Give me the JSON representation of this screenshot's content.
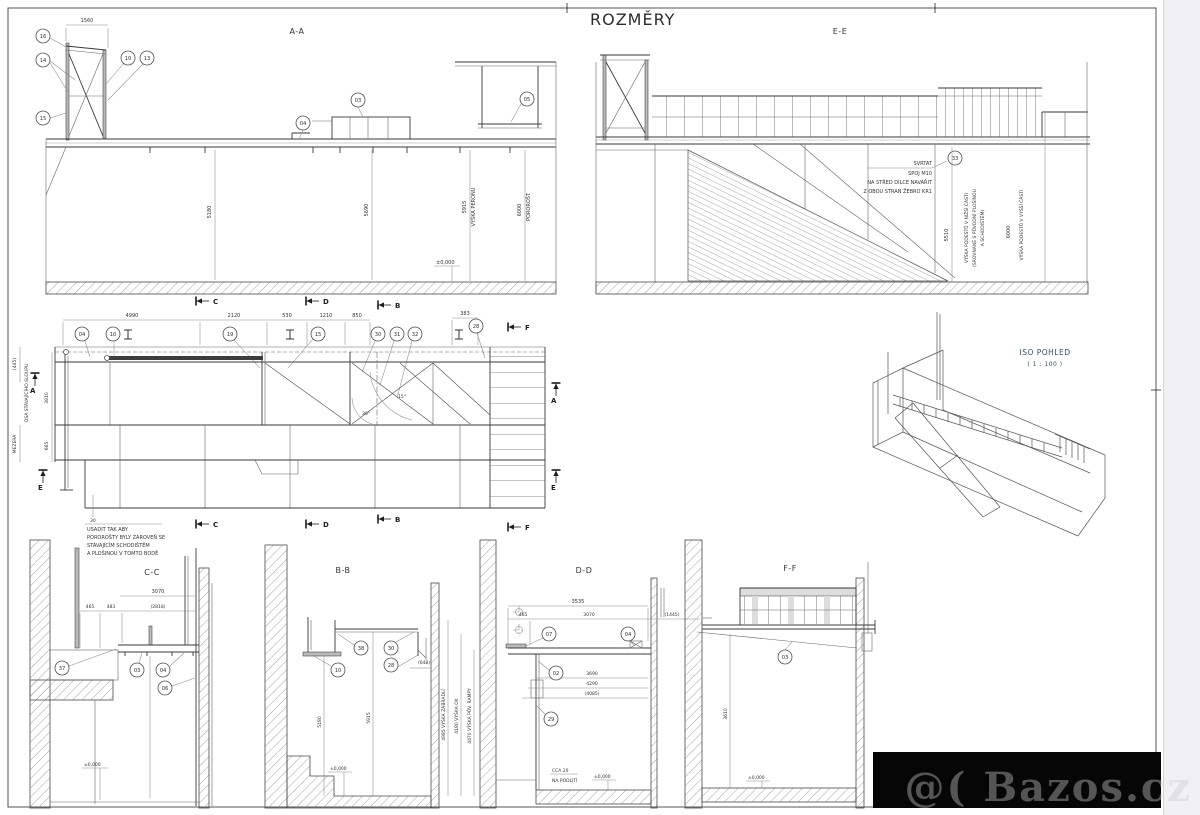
{
  "page": {
    "title": "ROZMĚRY",
    "watermark": "@( Bazos.cz"
  },
  "aa": {
    "label": "A-A",
    "dim_top": "1560",
    "balloons": [
      "16",
      "14",
      "15",
      "10",
      "13",
      "04",
      "03",
      "05"
    ],
    "vdim1": "5180",
    "vdim2": "5690",
    "vdim3": "5915",
    "vlabel3": "VÝŠKA PERONU",
    "vdim4": "6000",
    "vlabel4": "POROROŠT",
    "elevation": "±0,000"
  },
  "ee": {
    "label": "E-E",
    "note": [
      "SVRTAT",
      "SPOJ M10",
      "NA STŘED DÍLCE NAVAŘIT",
      "Z OBOU STRAN ŽEBRO KR1"
    ],
    "balloon": "33",
    "vdim1": "5510",
    "vlabel1a": "VÝŠKA PODESTŮ V NIŽŠÍ ČÁSTI",
    "vlabel1b": "(SROVNANÉ S PŮVODNÍ PLOŠINOU",
    "vlabel1c": "A SCHODIŠTĚM)",
    "vdim2": "6000",
    "vlabel2": "VÝŠKA PODESTŮ V VYŠŠÍ ČÁSTI"
  },
  "plan": {
    "dims_top": [
      "4990",
      "2120",
      "530",
      "1210",
      "850",
      "383"
    ],
    "balloons": [
      "04",
      "10",
      "19",
      "15",
      "30",
      "31",
      "32",
      "28"
    ],
    "angles": [
      "30°",
      "15°"
    ],
    "left_dim1": "(445)",
    "left_col": "OSA STÁVAJÍCÍHO SLOUPU",
    "left_dim2": "3810",
    "left_gap": "MEZERA",
    "left_dim3": "665",
    "note_no": "30",
    "note": [
      "USADIT TAK ABY",
      "POROROŠTY BYLY ZÁROVEŇ SE",
      "STÁVAJÍCÍM SCHODIŠTĚM",
      "A PLOŠINOU V TOMTO BODĚ"
    ],
    "markers": {
      "a": "A",
      "b": "B",
      "c": "C",
      "d": "D",
      "e": "E",
      "f": "F"
    }
  },
  "iso": {
    "title": "ISO POHLED",
    "scale": "( 1 : 100 )"
  },
  "cc": {
    "label": "C-C",
    "dim_top": "3070",
    "dims": [
      "465",
      "483",
      "(2818)"
    ],
    "balloons": [
      "37",
      "03",
      "04",
      "06"
    ],
    "elevation": "±0,000"
  },
  "bb": {
    "label": "B-B",
    "balloons": [
      "38",
      "30",
      "10",
      "28"
    ],
    "dim": "(648)",
    "vdim1": "5180",
    "vdim2": "5915",
    "elevation": "±0,000"
  },
  "dd": {
    "label": "D-D",
    "dim_top": "3535",
    "dims": [
      "465",
      "3070",
      "(1445)"
    ],
    "balloons": [
      "07",
      "04",
      "02",
      "29"
    ],
    "dims_bottom": [
      "3690",
      "4290",
      "(4085)"
    ],
    "vlabels": [
      "4985 VÝŠKA ZÁBRADLÍ",
      "4180 VÝŠKA OK",
      "4470 VÝŠKA PŮV. RAMPY"
    ],
    "note1": "CCA 20",
    "note2": "NA PODLITÍ",
    "elevation": "±0,000"
  },
  "ff": {
    "label": "F-F",
    "balloon": "03",
    "vdim": "3610",
    "elevation": "±0,000"
  }
}
